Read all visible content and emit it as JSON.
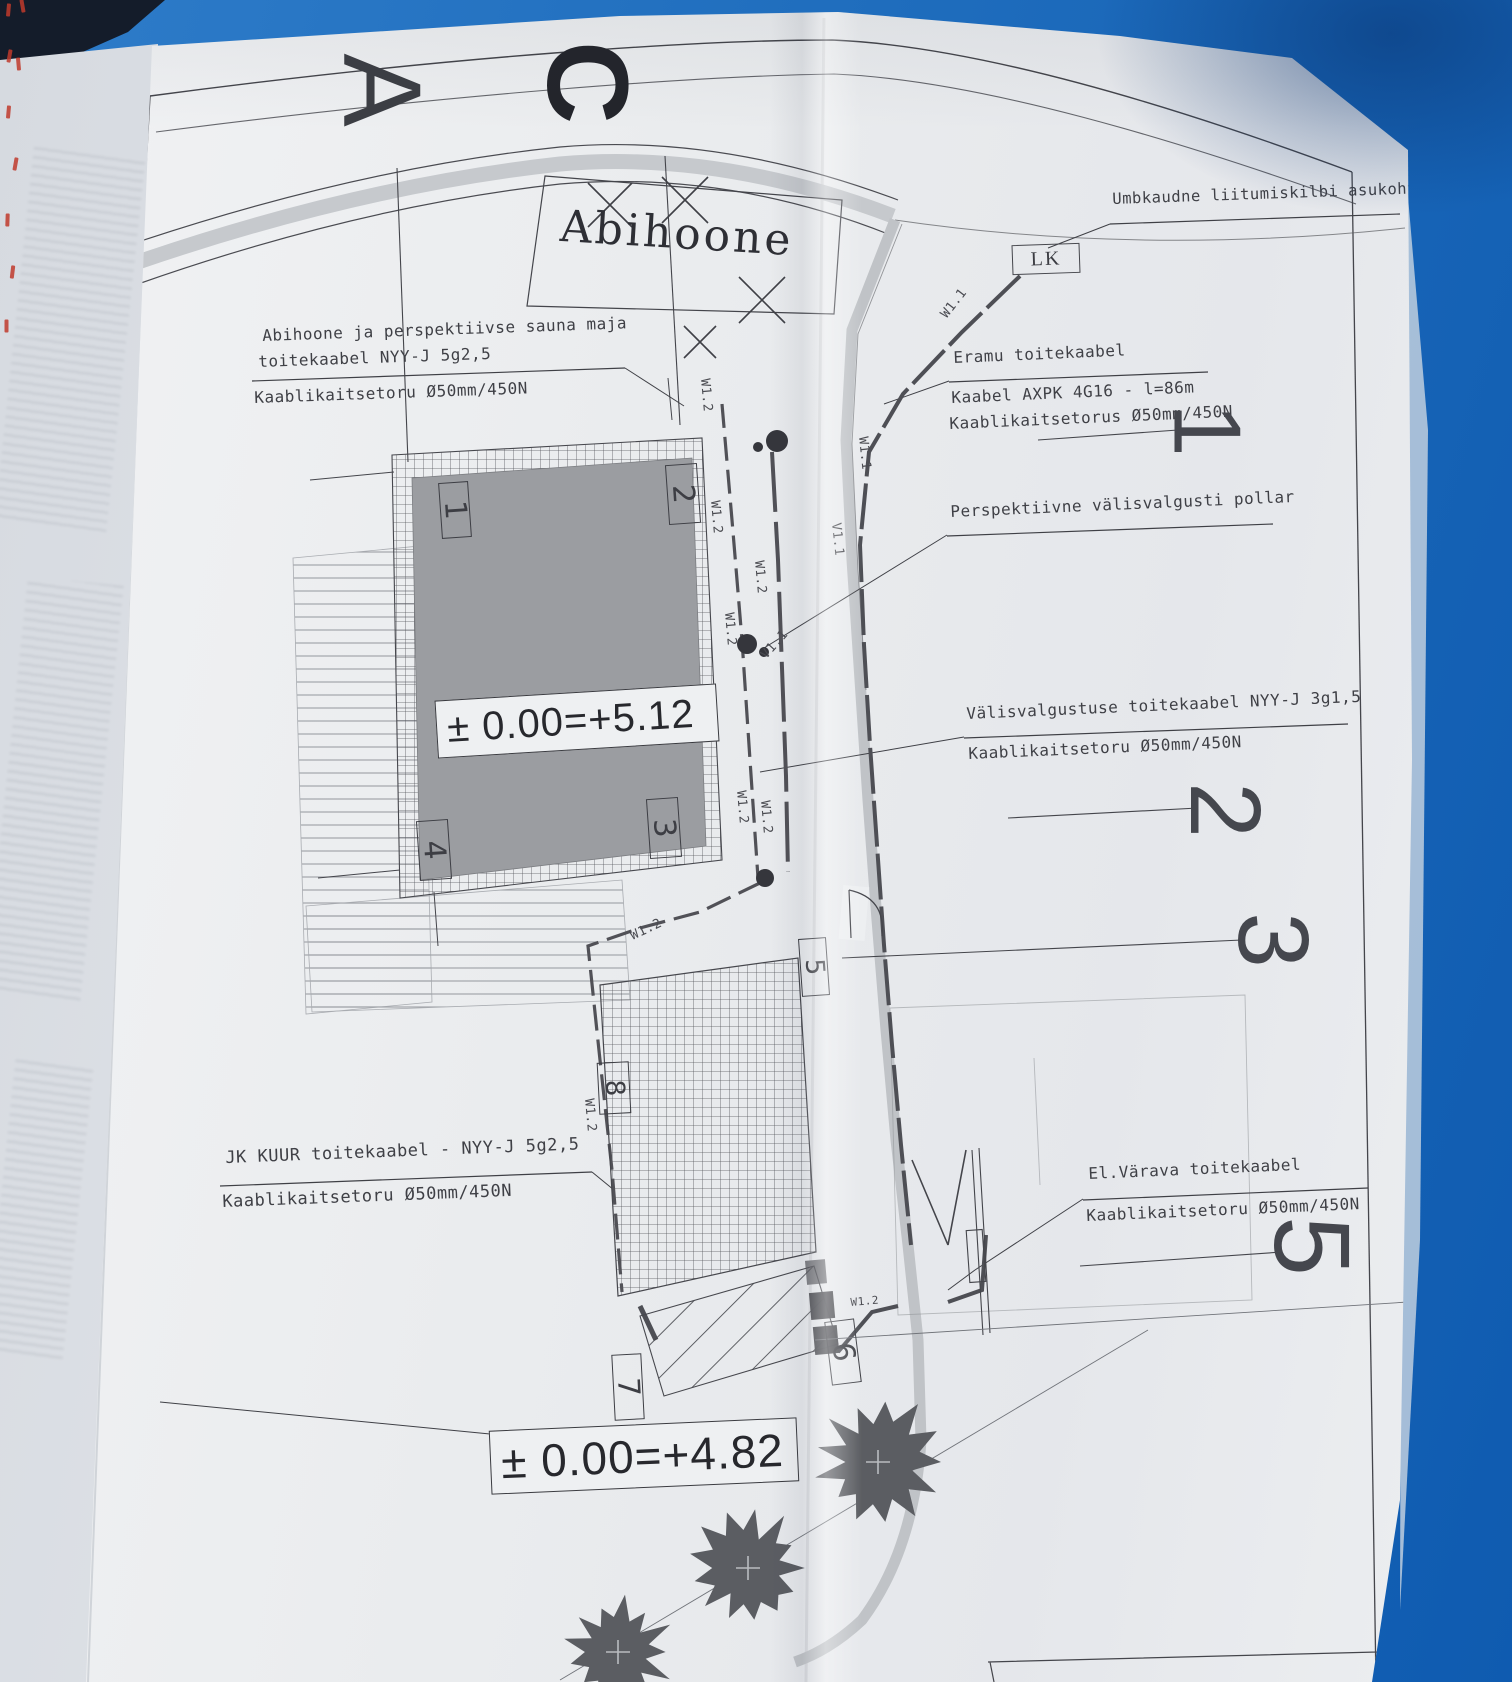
{
  "title_labels": {
    "building": "Abihoone",
    "lk": "LK"
  },
  "annotations": {
    "liitumiskilp": "Umbkaudne liitumiskilbi asukoht",
    "abihoone_l1": "Abihoone ja perspektiivse sauna maja",
    "abihoone_l2": "toitekaabel NYY-J 5g2,5",
    "abihoone_l3": "Kaablikaitsetoru Ø50mm/450N",
    "eramu_l1": "Eramu toitekaabel",
    "eramu_l2": "Kaabel AXPK 4G16 - l=86m",
    "eramu_l3": "Kaablikaitsetorus Ø50mm/450N",
    "pollar": "Perspektiivne välisvalgusti pollar",
    "valgustus_l1": "Välisvalgustuse toitekaabel NYY-J 3g1,5",
    "valgustus_l2": "Kaablikaitsetoru Ø50mm/450N",
    "kuur_l1": "JK KUUR toitekaabel - NYY-J 5g2,5",
    "kuur_l2": "Kaablikaitsetoru Ø50mm/450N",
    "varav_l1": "El.Värava toitekaabel",
    "varav_l2": "Kaablikaitsetoru Ø50mm/450N"
  },
  "elevations": {
    "main": "± 0.00=+5.12",
    "yard": "± 0.00=+4.82"
  },
  "axes": {
    "letters": [
      "A",
      "C"
    ],
    "numbers": [
      "1",
      "2",
      "3",
      "5"
    ]
  },
  "markers": [
    "1",
    "2",
    "3",
    "4",
    "5",
    "6",
    "7",
    "8"
  ],
  "tags": {
    "w12": "W1.2",
    "w11": "W1.1",
    "v11": "V1.1"
  },
  "colors": {
    "paper": "#edeff1",
    "ink": "#3f4046",
    "building_fill": "#9b9da1",
    "boundary_gray": "#c0c3c7",
    "cover_blue": "#1f6dbd",
    "tree_gray": "#5b5d62",
    "red_mark": "#c0392b"
  }
}
